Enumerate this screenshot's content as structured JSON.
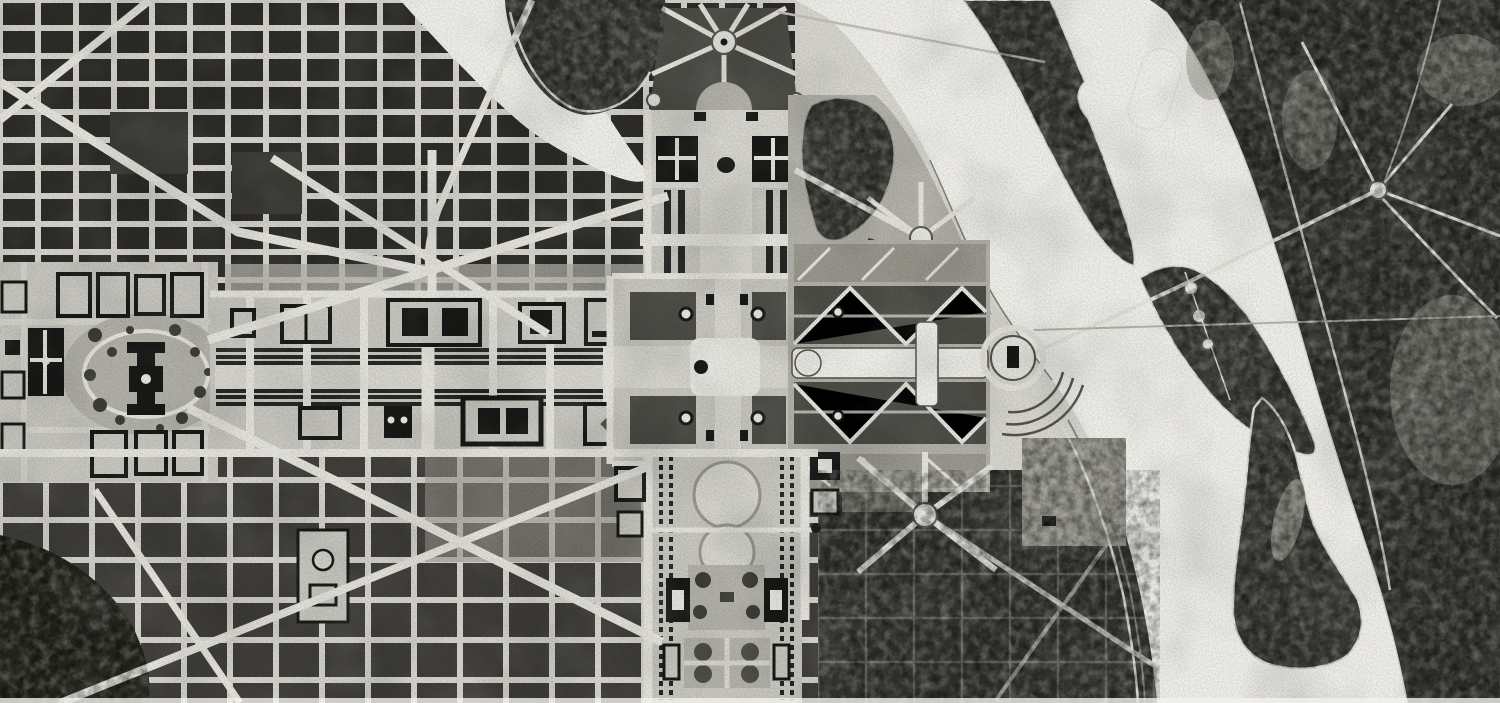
{
  "canvas": {
    "width": 1500,
    "height": 703
  },
  "image_kind": "halftone-print-city-plan",
  "palette": {
    "paper": "#d9d8d1",
    "water": "#f2f1ec",
    "street": "#d7d6cf",
    "avenue": "#e6e5de",
    "blockNW": "#2e2d2a",
    "blockSW": "#413f3b",
    "blockSE": "#393833",
    "gridSE": "#7b7a6f",
    "mallBase": "#c9c8c1",
    "lawn": "#d8d7d0",
    "panel": "#9a998f",
    "panelDark": "#4e4d47",
    "treeLine": "#272725",
    "parkDark": "#3e3d38",
    "forest": "#373631",
    "building": "#191917",
    "ringLight": "#e9e8e2",
    "outline": "#55544c",
    "midtone": "#b3b2aa"
  },
  "features": [
    {
      "id": "potomac-river",
      "label": "Potomac River"
    },
    {
      "id": "rock-creek-inlet",
      "label": "Rock Creek inlet"
    },
    {
      "id": "virginia-shore-forest",
      "label": "Wooded Virginia shore"
    },
    {
      "id": "arlington-rond-point",
      "label": "Rond-point in Virginia woods"
    },
    {
      "id": "analostan-island",
      "label": "Upstream river island"
    },
    {
      "id": "island-flats",
      "label": "Mid-river flats island"
    },
    {
      "id": "east-potomac-island",
      "label": "Lower river island"
    },
    {
      "id": "city-grid-northwest",
      "label": "Northwest city street grid"
    },
    {
      "id": "city-grid-southwest",
      "label": "Southwest city street grid"
    },
    {
      "id": "reclaimed-flats-parkland",
      "label": "Reclaimed flats parkland"
    },
    {
      "id": "capitol-grounds",
      "label": "Capitol and grounds"
    },
    {
      "id": "library-building",
      "label": "Library block"
    },
    {
      "id": "mall-tapis-vert",
      "label": "Mall tapis vert with tree rows"
    },
    {
      "id": "union-square",
      "label": "Union Square"
    },
    {
      "id": "white-house-compound",
      "label": "White House and executive buildings"
    },
    {
      "id": "radiating-avenues-fan",
      "label": "Radiating avenues fan"
    },
    {
      "id": "presidents-axis-garden",
      "label": "President's axis garden"
    },
    {
      "id": "ornamental-pond",
      "label": "Ornamental pond"
    },
    {
      "id": "washington-monument-garden",
      "label": "Monument formal garden"
    },
    {
      "id": "washington-monument",
      "label": "Washington Monument"
    },
    {
      "id": "canal-reflecting-garden",
      "label": "Canal and bosquet garden"
    },
    {
      "id": "lincoln-memorial-circle",
      "label": "Memorial rond-point at river"
    },
    {
      "id": "memorial-bridge-axis",
      "label": "Memorial bridge axis"
    },
    {
      "id": "watergate-terraces",
      "label": "Watergate terrace arcs"
    },
    {
      "id": "south-axis-gardens",
      "label": "South axis pools and gardens"
    },
    {
      "id": "pennsylvania-avenue",
      "label": "Diagonal avenue NW"
    },
    {
      "id": "maryland-avenue",
      "label": "Diagonal avenue SW"
    },
    {
      "id": "riverside-drive",
      "label": "Riverside drive"
    }
  ]
}
